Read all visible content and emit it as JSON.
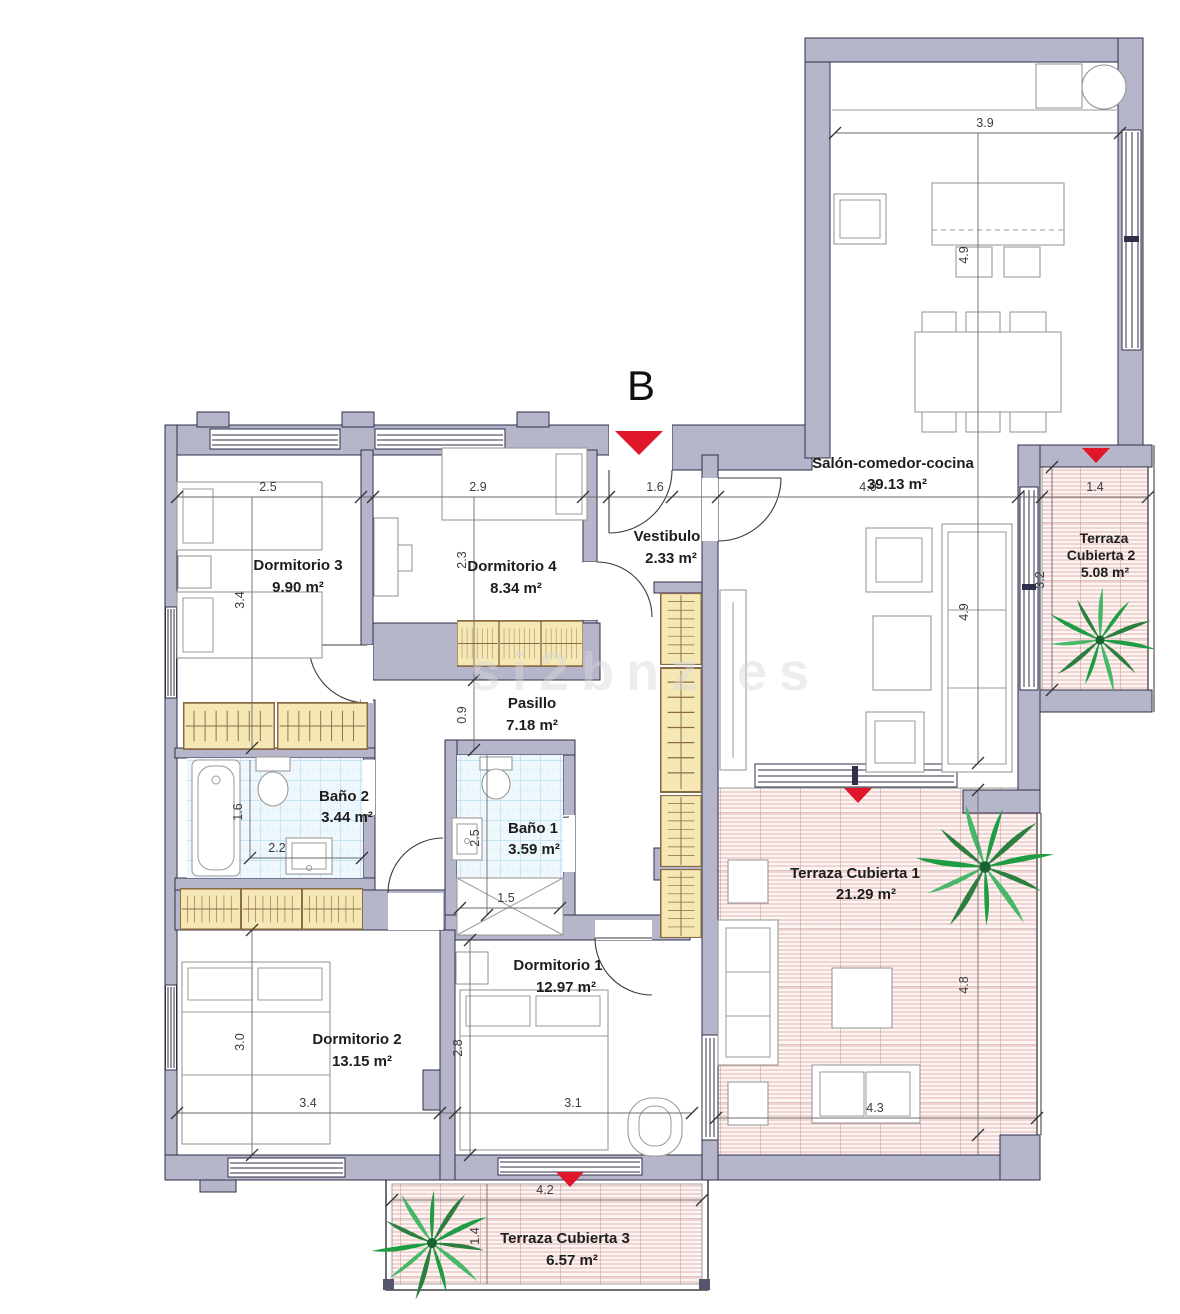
{
  "plan": {
    "unit_label": "B",
    "watermark": "si2bnz es"
  },
  "rooms": {
    "dormitorio3": {
      "name": "Dormitorio 3",
      "area": "9.90 m²"
    },
    "dormitorio4": {
      "name": "Dormitorio 4",
      "area": "8.34 m²"
    },
    "vestibulo": {
      "name": "Vestibulo",
      "area": "2.33 m²"
    },
    "salon": {
      "name": "Salón-comedor-cocina",
      "area": "39.13 m²"
    },
    "pasillo": {
      "name": "Pasillo",
      "area": "7.18 m²"
    },
    "bano2": {
      "name": "Baño 2",
      "area": "3.44 m²"
    },
    "bano1": {
      "name": "Baño 1",
      "area": "3.59 m²"
    },
    "dormitorio2": {
      "name": "Dormitorio 2",
      "area": "13.15 m²"
    },
    "dormitorio1": {
      "name": "Dormitorio 1",
      "area": "12.97 m²"
    },
    "terraza1": {
      "name": "Terraza Cubierta 1",
      "area": "21.29 m²"
    },
    "terraza2": {
      "name_line1": "Terraza",
      "name_line2": "Cubierta 2",
      "area": "5.08 m²"
    },
    "terraza3": {
      "name": "Terraza Cubierta 3",
      "area": "6.57 m²"
    }
  },
  "dimensions": {
    "dorm3_w": "2.5",
    "dorm3_h": "3.4",
    "dorm4_w": "2.9",
    "dorm4_h": "2.3",
    "vestibulo_w": "1.6",
    "salon_w": "4.0",
    "salon_h": "4.9",
    "kitchen_w": "3.9",
    "kitchen_h": "4.9",
    "pasillo_h": "0.9",
    "bano2_w": "2.2",
    "bano2_h": "1.6",
    "bano1_h": "2.5",
    "bano1_w": "1.5",
    "dorm2_h": "3.0",
    "dorm2_w": "3.4",
    "dorm1_h": "2.8",
    "dorm1_w": "3.1",
    "terraza1_w": "4.3",
    "terraza1_h": "4.8",
    "terraza2_w": "1.4",
    "terraza2_h": "3.2",
    "terraza3_w": "4.2",
    "terraza3_h": "1.4"
  },
  "colors": {
    "wall": "#b6b6cb",
    "wall_outline": "#2f2f49",
    "tile_line": "#9fd2ec",
    "wardrobe_fill": "#f5e8b4",
    "wardrobe_line": "#8a6a45",
    "terrace_bg": "#fcf5f3",
    "terrace_line": "#dc9d99",
    "marker_red": "#e0162b",
    "palm_green": "#1f9d45"
  }
}
